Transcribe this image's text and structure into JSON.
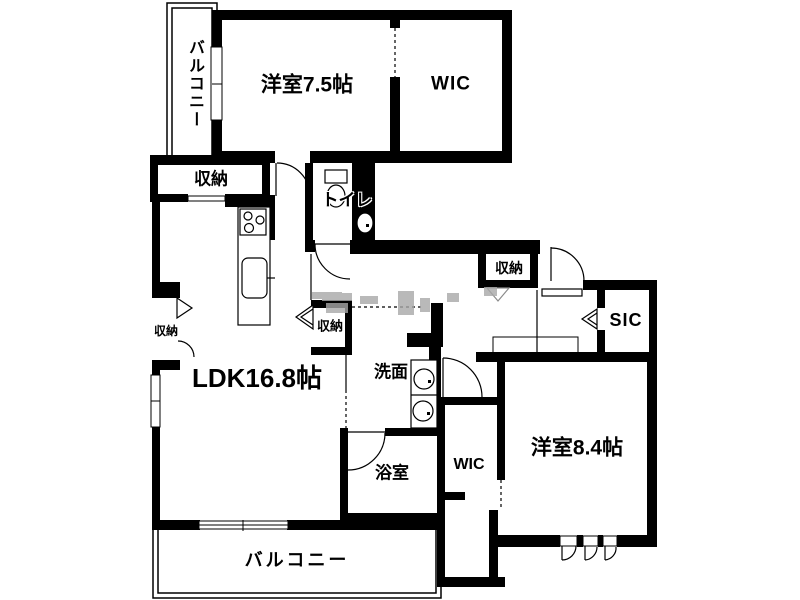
{
  "rooms": {
    "balcony_top": {
      "label": "バルコニー"
    },
    "bedroom_75": {
      "label": "洋室7.5帖"
    },
    "wic_top": {
      "label": "WIC"
    },
    "storage_top": {
      "label": "収納"
    },
    "toilet": {
      "label": "トイレ"
    },
    "storage_left": {
      "label": "収納"
    },
    "storage_mid": {
      "label": "収納"
    },
    "storage_hall": {
      "label": "収納"
    },
    "ldk": {
      "label": "LDK16.8帖"
    },
    "washroom": {
      "label": "洗面"
    },
    "bathroom": {
      "label": "浴室"
    },
    "wic_bottom": {
      "label": "WIC"
    },
    "bedroom_84": {
      "label": "洋室8.4帖"
    },
    "sic": {
      "label": "SIC"
    },
    "balcony_bottom": {
      "label": "バルコニー"
    }
  },
  "colors": {
    "wall": "#000000",
    "background": "#ffffff",
    "watermark": "#a8a8a8"
  }
}
